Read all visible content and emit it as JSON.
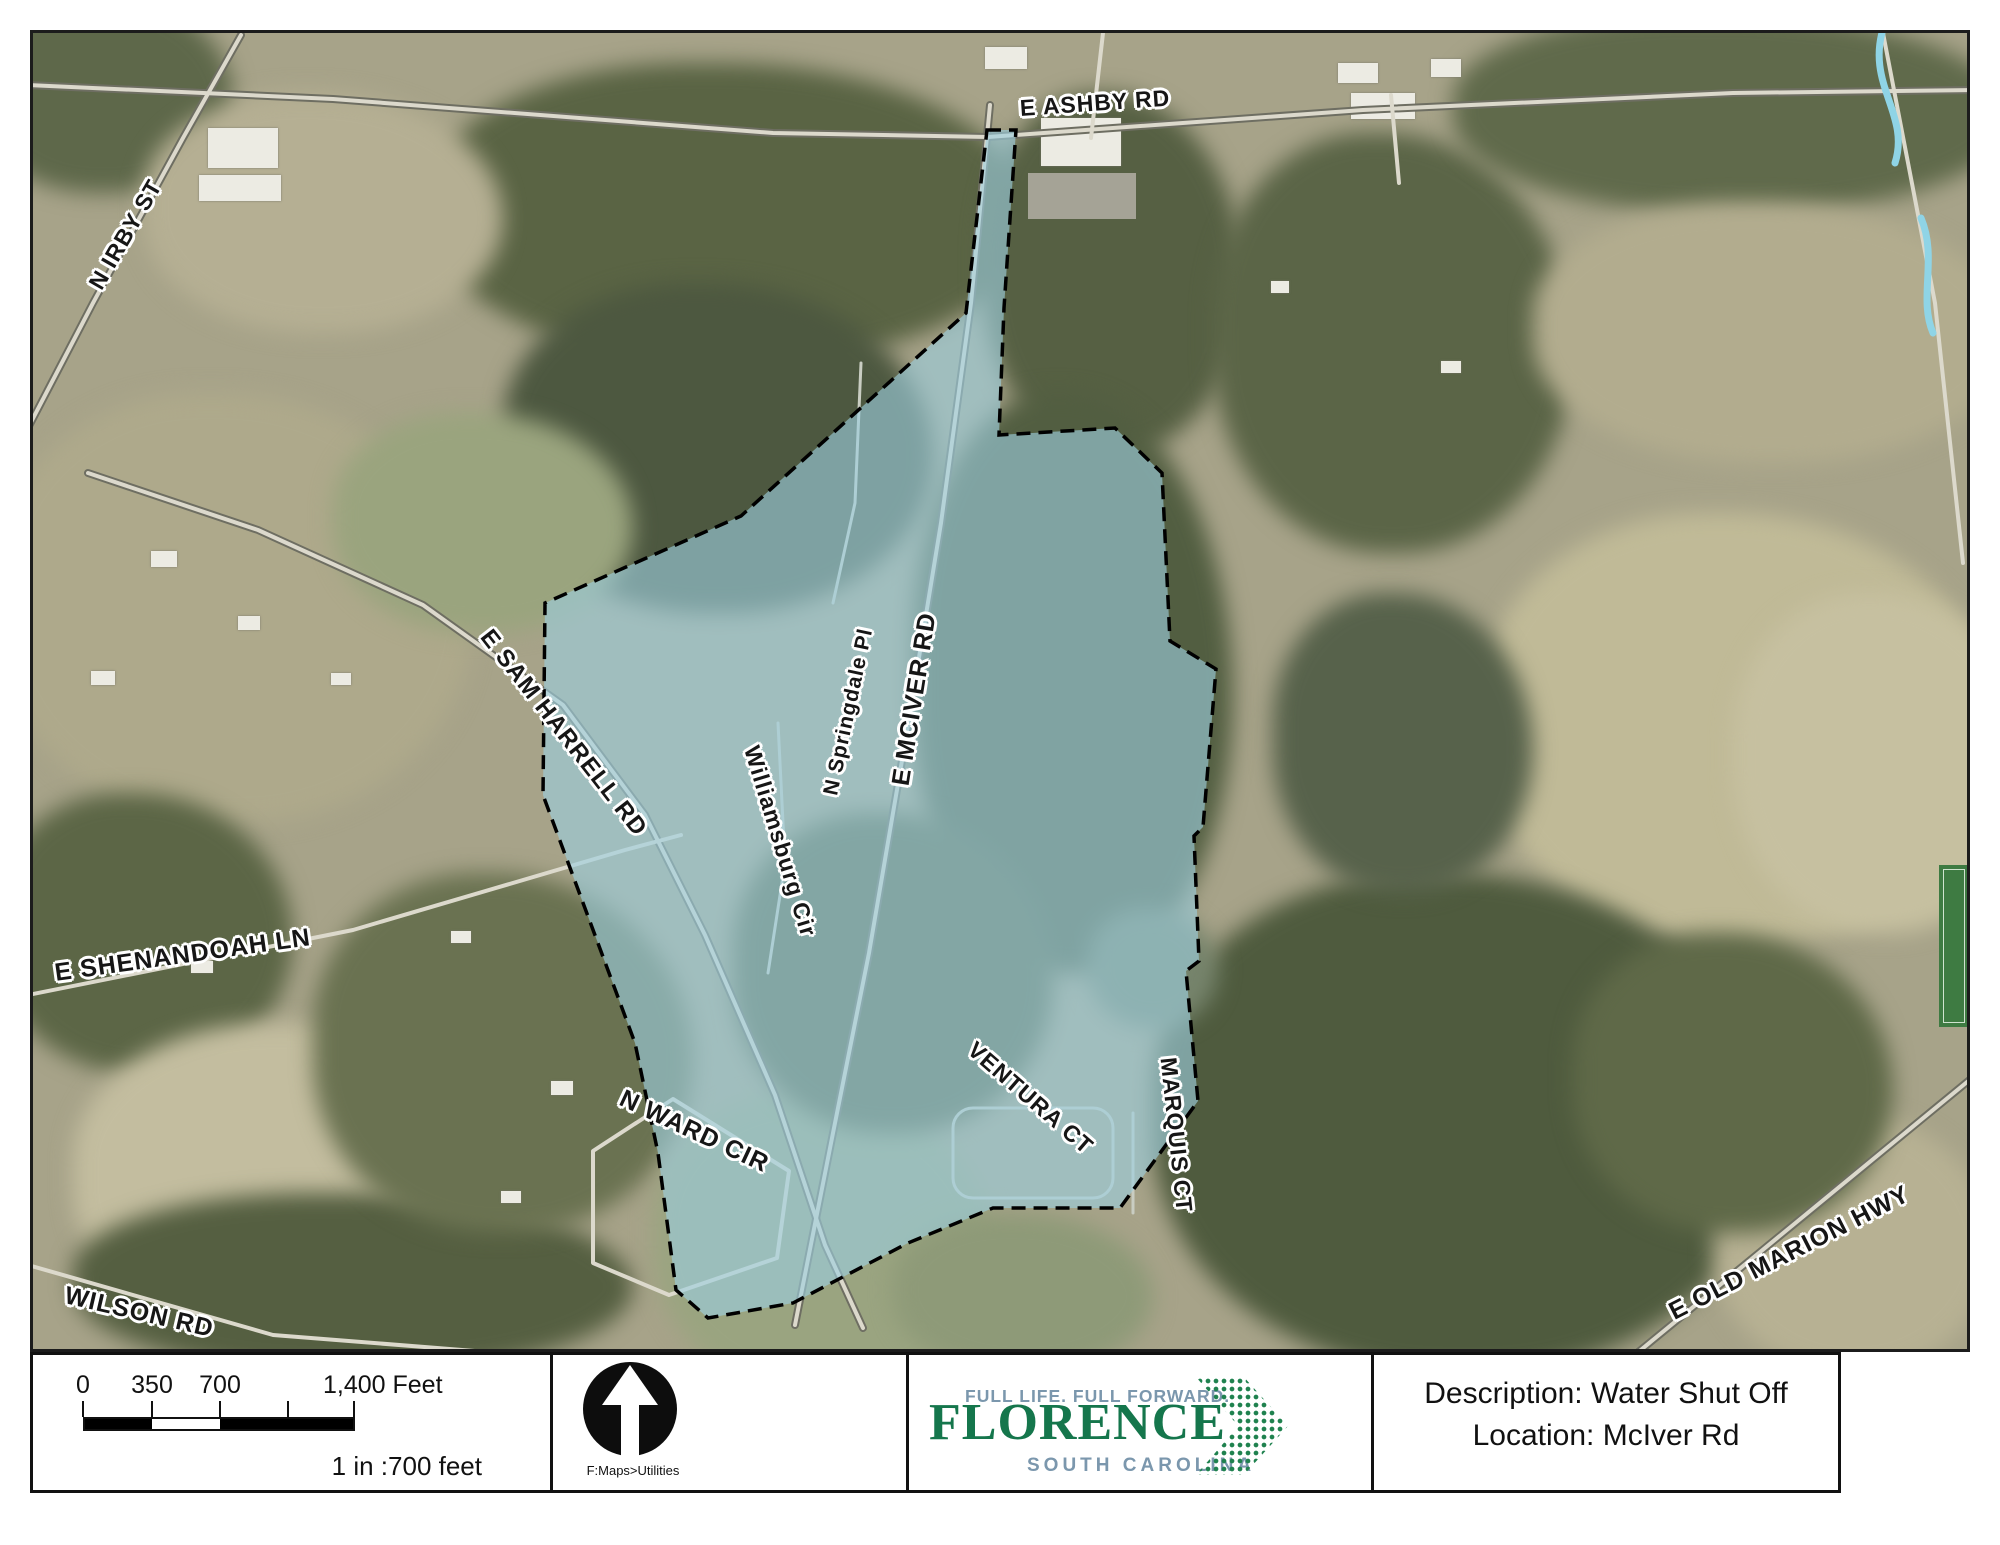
{
  "map": {
    "overlay_fill": "#9dcfde",
    "overlay_border": "#000000",
    "road_labels": [
      {
        "name": "e-ashby-rd",
        "text": "E ASHBY RD"
      },
      {
        "name": "n-irby-st",
        "text": "N IRBY ST"
      },
      {
        "name": "e-sam-harrell-rd",
        "text": "E SAM HARRELL RD"
      },
      {
        "name": "e-shenandoah-ln",
        "text": "E SHENANDOAH LN"
      },
      {
        "name": "williamsburg-cir",
        "text": "Williamsburg Cir"
      },
      {
        "name": "n-springdale-pl",
        "text": "N Springdale Pl"
      },
      {
        "name": "e-mciver-rd",
        "text": "E MCIVER RD"
      },
      {
        "name": "ventura-ct",
        "text": "VENTURA CT"
      },
      {
        "name": "marquis-ct",
        "text": "MARQUIS CT"
      },
      {
        "name": "n-ward-cir",
        "text": "N WARD CIR"
      },
      {
        "name": "wilson-rd",
        "text": "WILSON RD"
      },
      {
        "name": "e-old-marion-hwy",
        "text": "E OLD MARION HWY"
      }
    ]
  },
  "footer": {
    "scale": {
      "tick0": "0",
      "tick1": "350",
      "tick2": "700",
      "tick3": "1,400 Feet",
      "ratio": "1 in :700 feet"
    },
    "north": {
      "caption": "F:Maps>Utilities"
    },
    "logo": {
      "tagline": "FULL LIFE. FULL FORWARD.",
      "city": "FLORENCE",
      "state": "SOUTH CAROLINA",
      "green": "#15764c",
      "slate": "#7b97ad"
    },
    "info": {
      "description": "Description: Water Shut Off",
      "location": "Location: McIver Rd"
    }
  }
}
